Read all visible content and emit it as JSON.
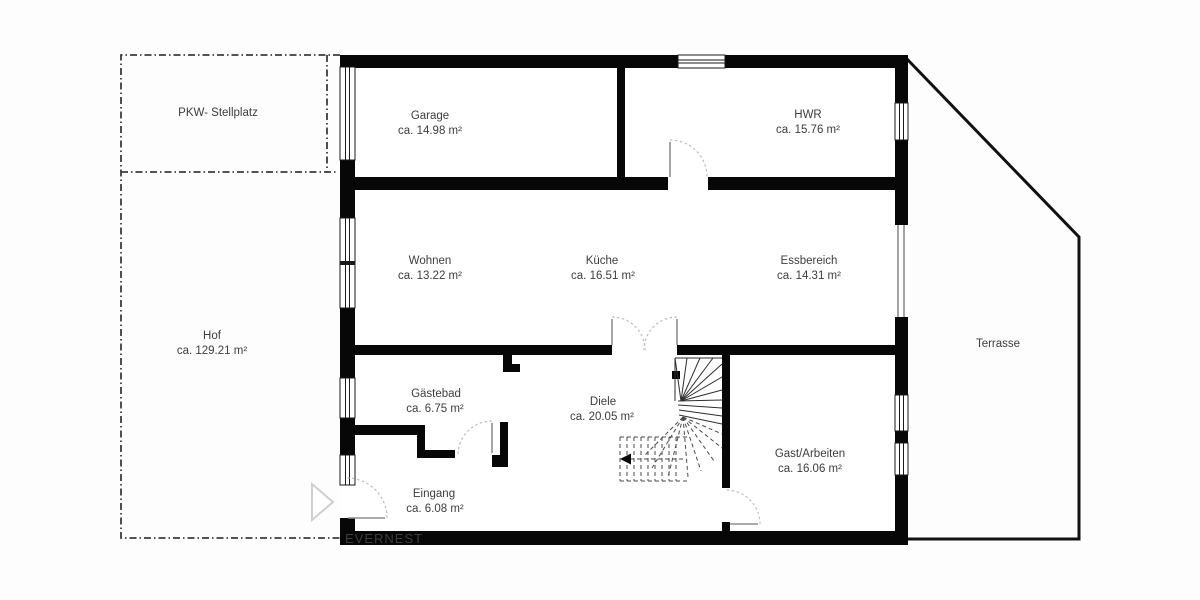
{
  "brand": {
    "watermark": "EVERNEST"
  },
  "colors": {
    "wall": "#070707",
    "text": "#3d3d3d",
    "watermark_text": "#f5f5f5",
    "background": "#fdfdfd",
    "door_arc": "#bdbdbd",
    "door_leaf": "#8f8f8f",
    "stair_line": "#2e2e2e",
    "dashed_boundary": "#3c3c3c"
  },
  "rooms": {
    "pkw": {
      "name": "PKW- Stellplatz"
    },
    "garage": {
      "name": "Garage",
      "area": "ca. 14.98 m²"
    },
    "hwr": {
      "name": "HWR",
      "area": "ca. 15.76 m²"
    },
    "wohnen": {
      "name": "Wohnen",
      "area": "ca. 13.22 m²"
    },
    "kueche": {
      "name": "Küche",
      "area": "ca. 16.51 m²"
    },
    "essbereich": {
      "name": "Essbereich",
      "area": "ca. 14.31 m²"
    },
    "hof": {
      "name": "Hof",
      "area": "ca. 129.21 m²"
    },
    "gaestebad": {
      "name": "Gästebad",
      "area": "ca. 6.75 m²"
    },
    "diele": {
      "name": "Diele",
      "area": "ca. 20.05 m²"
    },
    "eingang": {
      "name": "Eingang",
      "area": "ca. 6.08 m²"
    },
    "gast": {
      "name": "Gast/Arbeiten",
      "area": "ca. 16.06 m²"
    },
    "terrasse": {
      "name": "Terrasse"
    }
  }
}
